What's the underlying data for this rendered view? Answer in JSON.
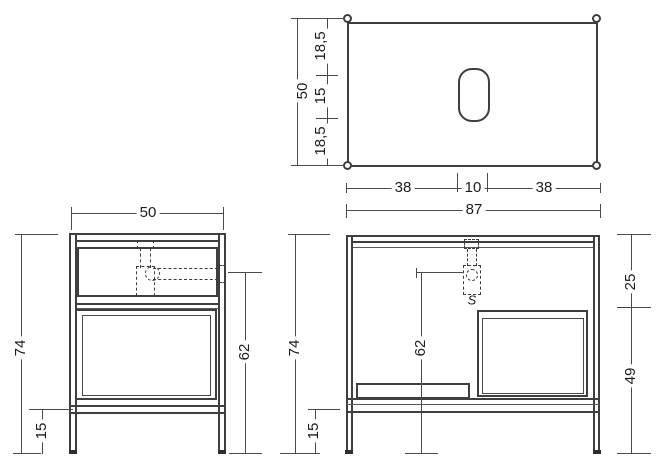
{
  "top_view": {
    "depth_chain": [
      "18,5",
      "15",
      "18,5"
    ],
    "depth_total": "50",
    "width_chain": [
      "38",
      "10",
      "38"
    ],
    "width_total": "87"
  },
  "side_view": {
    "width": "50",
    "height_total": "74",
    "leg_height": "15",
    "drain_height": "62"
  },
  "front_view": {
    "height_total": "74",
    "leg_height": "15",
    "upper_section": "25",
    "lower_section": "49",
    "drain_height": "62",
    "siphon_label": "S"
  }
}
